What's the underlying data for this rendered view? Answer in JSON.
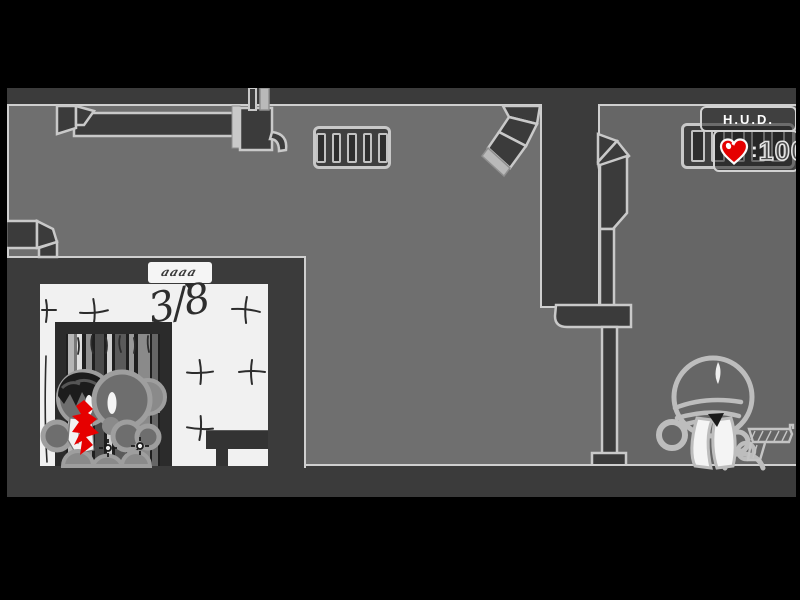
{
  "hud": {
    "title": "H.U.D.",
    "health_separator": ":",
    "health_value": "100"
  },
  "room": {
    "wall_text": "3/8",
    "sign_text": "aaaa"
  },
  "colors": {
    "letterbox": "#000000",
    "background_left": "#6f6f6f",
    "background_right": "#666666",
    "wall_dark": "#3b3b3b",
    "outline_light": "#cfcfcf",
    "room_white": "#f1f1f1",
    "blood_red": "#e60000",
    "heart_red": "#e50000"
  }
}
